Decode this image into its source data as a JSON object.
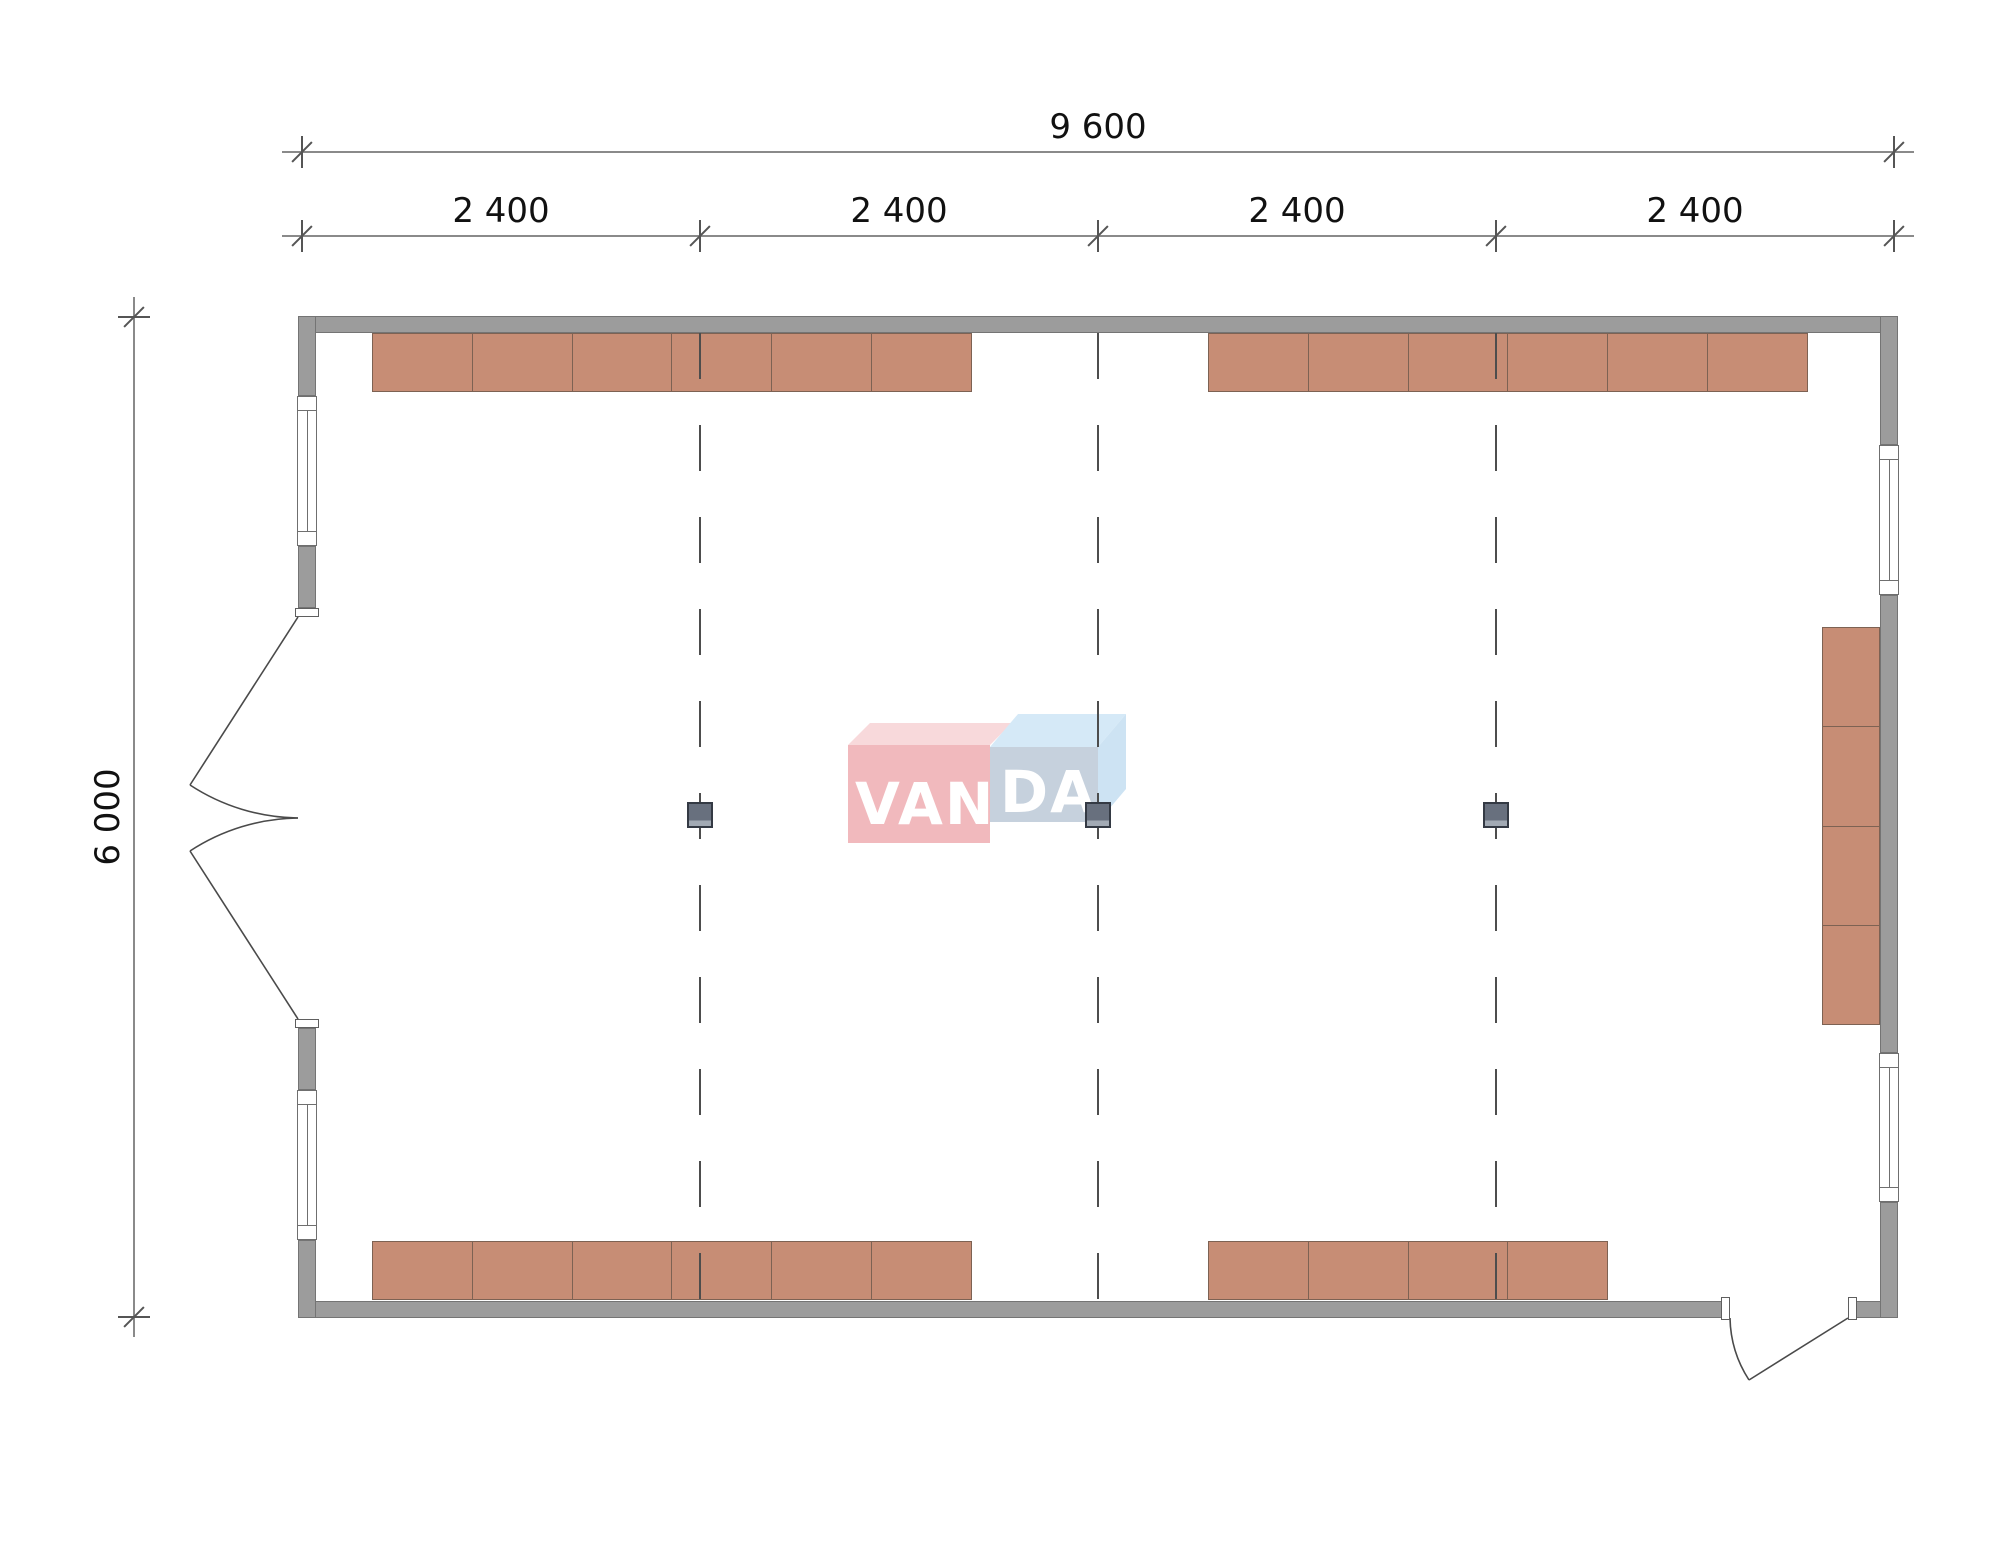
{
  "drawing": {
    "kind": "architectural-floor-plan",
    "dimensions": {
      "overall_width": "9 600",
      "bays": [
        "2 400",
        "2 400",
        "2 400",
        "2 400"
      ],
      "overall_depth": "6 000"
    },
    "watermark": {
      "brand": "VANDA",
      "left_segment": "VAN",
      "right_segment": "DA"
    },
    "structure": {
      "grid_lines": 3,
      "columns": 3,
      "windows": [
        {
          "wall": "west",
          "position": "upper"
        },
        {
          "wall": "west",
          "position": "lower"
        },
        {
          "wall": "east",
          "position": "upper"
        },
        {
          "wall": "east",
          "position": "lower"
        }
      ],
      "doors": [
        {
          "wall": "west",
          "type": "double-leaf-outswing"
        },
        {
          "wall": "south",
          "type": "single-leaf-outswing"
        }
      ]
    },
    "furniture": {
      "runs": [
        {
          "id": "top-left",
          "wall": "north",
          "modules": 6
        },
        {
          "id": "top-right",
          "wall": "north",
          "modules": 6
        },
        {
          "id": "bottom-left",
          "wall": "south",
          "modules": 6
        },
        {
          "id": "bottom-right",
          "wall": "south",
          "modules": 4
        },
        {
          "id": "right-side",
          "wall": "east",
          "modules": 4
        }
      ]
    }
  },
  "colors": {
    "wall": "#9c9c9c",
    "wall_border": "#747474",
    "cabinet": "#c78d75",
    "cabinet_border": "#7d6253",
    "column": "#68707e",
    "column_border": "#343a44",
    "column_foot": "#a2aab4",
    "grid_line": "#4d4d4d",
    "dim_line": "#8a8a8a",
    "dim_tick": "#555555",
    "dim_text": "#111111",
    "window_line": "#6f6f6f",
    "door_line": "#4a4a4a",
    "logo_red_front": "#f1b6ba",
    "logo_red_top": "#f8d8da",
    "logo_blue_front": "#c3cfdc",
    "logo_blue_top": "#d3e8f7",
    "logo_blue_side": "#cbe2f3",
    "logo_text": "#ffffff"
  }
}
